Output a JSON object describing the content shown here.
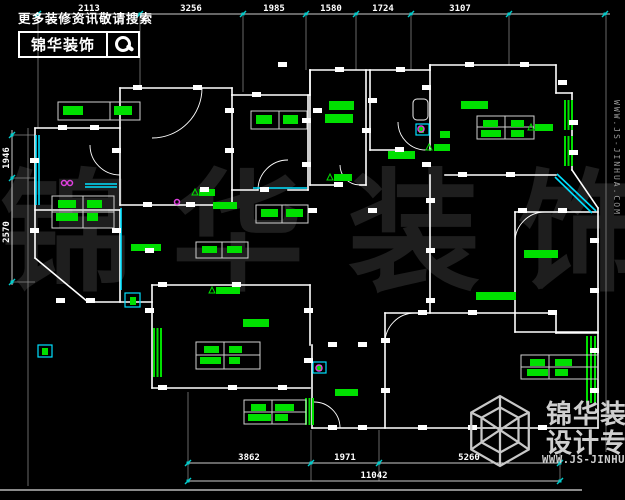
{
  "meta": {
    "width": 625,
    "height": 500,
    "bg": "#000000"
  },
  "colors": {
    "wall": "#ffffff",
    "dim_text": "#ffffff",
    "dim_line": "#cccccc",
    "ext_line": "#8a8a8a",
    "green": "#00e000",
    "cyan": "#00e0ff",
    "magenta": "#e040e0",
    "watermark": "#1e1e1e",
    "logo_gray": "#cfcfcf",
    "tick": "#00cccc"
  },
  "header": {
    "search_hint": "更多装修资讯敬请搜索",
    "logo_text": "锦华装饰",
    "icon": "magnifier"
  },
  "watermark": {
    "chars": [
      "锦",
      "华",
      "装",
      "饰"
    ]
  },
  "footer_logo": {
    "brand": "锦华装饰",
    "tagline": "设计专家",
    "url": "WWW.JS-JINHUA.COM",
    "icon": "cube-wireframe"
  },
  "side_url": "WWW.JS-JINHUA.COM",
  "dimensions": {
    "top": {
      "line_y": 14,
      "x_start": 30,
      "x_end": 610,
      "ticks": [
        38,
        140,
        243,
        306,
        356,
        411,
        509,
        605
      ],
      "labels": [
        {
          "text": "2113",
          "x": 89
        },
        {
          "text": "3256",
          "x": 191
        },
        {
          "text": "1985",
          "x": 274
        },
        {
          "text": "1580",
          "x": 331
        },
        {
          "text": "1724",
          "x": 383
        },
        {
          "text": "3107",
          "x": 460
        }
      ]
    },
    "bottom1": {
      "line_y": 463,
      "x_start": 188,
      "x_end": 560,
      "ticks": [
        188,
        311,
        379,
        560
      ],
      "labels": [
        {
          "text": "3862",
          "x": 249
        },
        {
          "text": "1971",
          "x": 345
        },
        {
          "text": "5260",
          "x": 469
        }
      ]
    },
    "bottom2": {
      "line_y": 481,
      "x_start": 188,
      "x_end": 560,
      "ticks": [
        188,
        560
      ],
      "labels": [
        {
          "text": "11042",
          "x": 374
        }
      ]
    },
    "left": {
      "line_x": 12,
      "y_start": 130,
      "y_end": 285,
      "ticks": [
        135,
        178,
        282
      ],
      "labels": [
        {
          "text": "1946",
          "y": 158
        },
        {
          "text": "2570",
          "y": 232
        }
      ]
    }
  },
  "plan": {
    "walls": [
      [
        120,
        88,
        232,
        88
      ],
      [
        232,
        88,
        232,
        95
      ],
      [
        232,
        95,
        310,
        95
      ],
      [
        310,
        95,
        310,
        70
      ],
      [
        310,
        70,
        430,
        70
      ],
      [
        430,
        70,
        430,
        65
      ],
      [
        430,
        65,
        556,
        65
      ],
      [
        556,
        65,
        556,
        93
      ],
      [
        556,
        93,
        572,
        93
      ],
      [
        572,
        93,
        572,
        170
      ],
      [
        572,
        170,
        598,
        208
      ],
      [
        598,
        208,
        598,
        428
      ],
      [
        598,
        428,
        312,
        428
      ],
      [
        312,
        345,
        312,
        428
      ],
      [
        385,
        313,
        385,
        428
      ],
      [
        385,
        313,
        556,
        313
      ],
      [
        556,
        313,
        556,
        333
      ],
      [
        556,
        333,
        598,
        333
      ],
      [
        515,
        212,
        598,
        212
      ],
      [
        515,
        212,
        515,
        332
      ],
      [
        515,
        332,
        598,
        332
      ],
      [
        430,
        65,
        430,
        150
      ],
      [
        430,
        175,
        430,
        313
      ],
      [
        445,
        175,
        556,
        175
      ],
      [
        370,
        70,
        370,
        150
      ],
      [
        370,
        150,
        398,
        150
      ],
      [
        310,
        70,
        310,
        185
      ],
      [
        310,
        185,
        340,
        185
      ],
      [
        360,
        185,
        366,
        185
      ],
      [
        366,
        70,
        366,
        185
      ],
      [
        232,
        95,
        232,
        190
      ],
      [
        308,
        95,
        308,
        190
      ],
      [
        232,
        190,
        258,
        190
      ],
      [
        288,
        190,
        308,
        190
      ],
      [
        232,
        190,
        232,
        205
      ],
      [
        120,
        88,
        120,
        205
      ],
      [
        120,
        205,
        232,
        205
      ],
      [
        35,
        128,
        120,
        128
      ],
      [
        35,
        128,
        35,
        258
      ],
      [
        35,
        210,
        120,
        210
      ],
      [
        35,
        258,
        88,
        302
      ],
      [
        88,
        302,
        152,
        302
      ],
      [
        120,
        210,
        120,
        302
      ],
      [
        152,
        285,
        310,
        285
      ],
      [
        152,
        285,
        152,
        388
      ],
      [
        152,
        388,
        310,
        388
      ],
      [
        310,
        285,
        310,
        345
      ]
    ],
    "frame": [
      [
        0,
        490,
        582,
        490
      ]
    ],
    "ext": [
      [
        38,
        16,
        38,
        128
      ],
      [
        140,
        16,
        140,
        88
      ],
      [
        243,
        16,
        243,
        92
      ],
      [
        306,
        16,
        306,
        70
      ],
      [
        356,
        16,
        356,
        70
      ],
      [
        411,
        16,
        411,
        70
      ],
      [
        509,
        16,
        509,
        65
      ],
      [
        606,
        16,
        606,
        452
      ],
      [
        188,
        392,
        188,
        481
      ],
      [
        311,
        430,
        311,
        481
      ],
      [
        379,
        430,
        379,
        481
      ],
      [
        560,
        430,
        560,
        481
      ],
      [
        28,
        128,
        28,
        486
      ],
      [
        12,
        135,
        35,
        135
      ],
      [
        12,
        178,
        35,
        178
      ],
      [
        12,
        282,
        35,
        282
      ]
    ],
    "arcs": [
      "M202,88 A50,50 0 0 1 152,138",
      "M90,145 A30,30 0 0 0 120,175",
      "M258,190 A30,30 0 0 1 288,160",
      "M360,185 A20,20 0 0 1 340,165",
      "M426,150 A28,28 0 0 1 398,122",
      "M515,242 A30,30 0 0 1 545,212",
      "M415,313 A30,30 0 0 0 385,343",
      "M340,428 A26,26 0 0 0 314,402"
    ],
    "cyan_lines": [
      [
        36,
        135,
        36,
        205
      ],
      [
        39,
        135,
        39,
        205
      ],
      [
        121,
        208,
        121,
        290
      ],
      [
        85,
        184,
        117,
        184
      ],
      [
        85,
        187,
        117,
        187
      ],
      [
        253,
        188,
        307,
        188
      ],
      [
        557,
        174,
        596,
        211
      ],
      [
        555,
        177,
        592,
        213
      ]
    ],
    "cyan_rects": [
      [
        38,
        345,
        14,
        12
      ],
      [
        125,
        293,
        15,
        14
      ],
      [
        313,
        362,
        13,
        11
      ],
      [
        416,
        124,
        13,
        11
      ]
    ],
    "window_bars": [
      [
        565,
        100,
        565,
        130
      ],
      [
        568.5,
        100,
        568.5,
        130
      ],
      [
        572,
        100,
        572,
        130
      ],
      [
        565,
        136,
        565,
        166
      ],
      [
        568.5,
        136,
        568.5,
        166
      ],
      [
        572,
        136,
        572,
        166
      ],
      [
        154,
        328,
        154,
        377
      ],
      [
        157.5,
        328,
        157.5,
        377
      ],
      [
        161,
        328,
        161,
        377
      ],
      [
        306,
        398,
        306,
        425
      ],
      [
        309.5,
        398,
        309.5,
        425
      ],
      [
        313,
        398,
        313,
        425
      ],
      [
        587,
        336,
        587,
        403
      ],
      [
        591,
        336,
        591,
        403
      ],
      [
        595,
        336,
        595,
        403
      ]
    ],
    "tables": [
      {
        "x": 58,
        "y": 102,
        "w": 82,
        "h": 18,
        "vdiv": [
          110
        ],
        "hdiv": []
      },
      {
        "x": 52,
        "y": 196,
        "w": 62,
        "h": 32,
        "vdiv": [
          83
        ],
        "hdiv": [
          212
        ]
      },
      {
        "x": 251,
        "y": 111,
        "w": 56,
        "h": 18,
        "vdiv": [
          279
        ],
        "hdiv": []
      },
      {
        "x": 477,
        "y": 116,
        "w": 57,
        "h": 23,
        "vdiv": [
          505
        ],
        "hdiv": [
          127
        ]
      },
      {
        "x": 256,
        "y": 205,
        "w": 52,
        "h": 18,
        "vdiv": [
          282
        ],
        "hdiv": []
      },
      {
        "x": 196,
        "y": 242,
        "w": 52,
        "h": 16,
        "vdiv": [
          222
        ],
        "hdiv": []
      },
      {
        "x": 196,
        "y": 342,
        "w": 64,
        "h": 27,
        "vdiv": [
          224
        ],
        "hdiv": [
          355
        ]
      },
      {
        "x": 244,
        "y": 400,
        "w": 62,
        "h": 24,
        "vdiv": [
          272
        ],
        "hdiv": [
          412
        ]
      },
      {
        "x": 521,
        "y": 355,
        "w": 77,
        "h": 24,
        "vdiv": [
          549
        ],
        "hdiv": [
          367
        ]
      }
    ],
    "green_blocks": [
      [
        63,
        106,
        20,
        9
      ],
      [
        114,
        106,
        18,
        9
      ],
      [
        58,
        200,
        18,
        8
      ],
      [
        87,
        200,
        15,
        8
      ],
      [
        56,
        213,
        22,
        8
      ],
      [
        87,
        213,
        11,
        8
      ],
      [
        256,
        115,
        16,
        9
      ],
      [
        283,
        115,
        15,
        9
      ],
      [
        329,
        101,
        25,
        9
      ],
      [
        325,
        114,
        28,
        9
      ],
      [
        388,
        151,
        27,
        8
      ],
      [
        461,
        101,
        27,
        8
      ],
      [
        483,
        120,
        15,
        7
      ],
      [
        511,
        120,
        13,
        7
      ],
      [
        481,
        130,
        20,
        7
      ],
      [
        511,
        130,
        13,
        7
      ],
      [
        213,
        202,
        24,
        7
      ],
      [
        261,
        209,
        17,
        8
      ],
      [
        286,
        209,
        17,
        8
      ],
      [
        131,
        244,
        30,
        7
      ],
      [
        202,
        246,
        15,
        7
      ],
      [
        227,
        246,
        15,
        7
      ],
      [
        199,
        189,
        16,
        7
      ],
      [
        216,
        287,
        24,
        7
      ],
      [
        334,
        174,
        18,
        7
      ],
      [
        434,
        144,
        16,
        7
      ],
      [
        535,
        124,
        18,
        7
      ],
      [
        476,
        292,
        40,
        8
      ],
      [
        524,
        250,
        34,
        8
      ],
      [
        243,
        319,
        26,
        8
      ],
      [
        204,
        346,
        15,
        7
      ],
      [
        229,
        346,
        13,
        7
      ],
      [
        200,
        357,
        21,
        7
      ],
      [
        229,
        357,
        11,
        7
      ],
      [
        251,
        404,
        15,
        7
      ],
      [
        275,
        404,
        19,
        7
      ],
      [
        248,
        414,
        23,
        7
      ],
      [
        275,
        414,
        13,
        7
      ],
      [
        530,
        359,
        15,
        7
      ],
      [
        555,
        359,
        17,
        7
      ],
      [
        527,
        369,
        21,
        7
      ],
      [
        555,
        369,
        13,
        7
      ],
      [
        335,
        389,
        23,
        7
      ],
      [
        440,
        131,
        10,
        7
      ],
      [
        42,
        348,
        6,
        7
      ],
      [
        130,
        297,
        6,
        8
      ],
      [
        317,
        365,
        5,
        6
      ],
      [
        419,
        127,
        5,
        6
      ]
    ],
    "white_ticks": [
      [
        133,
        85
      ],
      [
        193,
        85
      ],
      [
        58,
        125
      ],
      [
        90,
        125
      ],
      [
        252,
        92
      ],
      [
        278,
        62
      ],
      [
        335,
        67
      ],
      [
        396,
        67
      ],
      [
        465,
        62
      ],
      [
        520,
        62
      ],
      [
        558,
        80
      ],
      [
        112,
        148
      ],
      [
        30,
        158
      ],
      [
        30,
        228
      ],
      [
        112,
        228
      ],
      [
        143,
        202
      ],
      [
        186,
        202
      ],
      [
        225,
        108
      ],
      [
        225,
        148
      ],
      [
        302,
        118
      ],
      [
        302,
        162
      ],
      [
        313,
        108
      ],
      [
        362,
        128
      ],
      [
        368,
        98
      ],
      [
        422,
        85
      ],
      [
        422,
        162
      ],
      [
        426,
        198
      ],
      [
        426,
        248
      ],
      [
        426,
        298
      ],
      [
        458,
        172
      ],
      [
        506,
        172
      ],
      [
        590,
        238
      ],
      [
        590,
        288
      ],
      [
        590,
        348
      ],
      [
        590,
        388
      ],
      [
        518,
        208
      ],
      [
        558,
        208
      ],
      [
        145,
        248
      ],
      [
        145,
        308
      ],
      [
        56,
        298
      ],
      [
        86,
        298
      ],
      [
        158,
        282
      ],
      [
        232,
        282
      ],
      [
        158,
        385
      ],
      [
        228,
        385
      ],
      [
        278,
        385
      ],
      [
        304,
        308
      ],
      [
        304,
        358
      ],
      [
        328,
        342
      ],
      [
        358,
        342
      ],
      [
        328,
        425
      ],
      [
        358,
        425
      ],
      [
        418,
        310
      ],
      [
        468,
        310
      ],
      [
        418,
        425
      ],
      [
        468,
        425
      ],
      [
        538,
        425
      ],
      [
        381,
        338
      ],
      [
        381,
        388
      ],
      [
        548,
        310
      ],
      [
        200,
        187
      ],
      [
        260,
        187
      ],
      [
        308,
        208
      ],
      [
        368,
        208
      ],
      [
        395,
        147
      ],
      [
        334,
        182
      ],
      [
        569,
        120
      ],
      [
        569,
        150
      ]
    ],
    "magenta_circles": [
      [
        64,
        183,
        2.5
      ],
      [
        70,
        183,
        2.5
      ],
      [
        177,
        202,
        2.5
      ],
      [
        319,
        368,
        3
      ],
      [
        421,
        129,
        3
      ]
    ],
    "triangles": [
      [
        196,
        195
      ],
      [
        213,
        293
      ],
      [
        331,
        180
      ],
      [
        430,
        150
      ],
      [
        532,
        130
      ]
    ],
    "fixtures": [
      {
        "type": "toilet",
        "x": 413,
        "y": 99,
        "w": 15,
        "h": 21
      }
    ]
  }
}
